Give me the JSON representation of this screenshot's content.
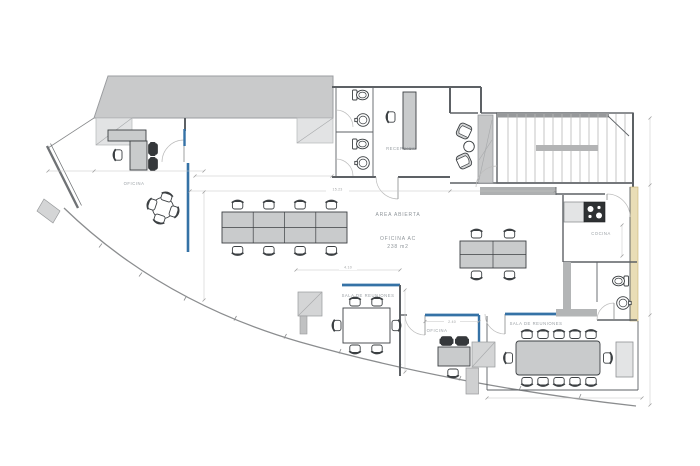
{
  "meta": {
    "title": "Office floor plan"
  },
  "colors": {
    "background": "#ffffff",
    "wall_band": "#c9cacb",
    "wall_gray": "#b3b5b6",
    "column_gray": "#d4d5d6",
    "line_dark": "#5d6165",
    "glass_blue": "#3572a6",
    "accent_tan": "#e9ddb6",
    "furniture_gray": "#c9cbcc",
    "furniture_dark": "#35383b",
    "label_gray": "#8f959a",
    "dim_gray": "#a3a5a7"
  },
  "labels": {
    "oficina_left": "OFICINA",
    "area_abierta": "AREA ABIERTA",
    "oficina_ac": "OFICINA AC",
    "oficina_ac_area": "238 m2",
    "recepcion": "RECEPCION",
    "cocina": "COCINA",
    "sala_reuniones_center": "SALA DE REUNIONES",
    "oficina_bottom": "OFICINA",
    "sala_reuniones_right": "SALA DE REUNIONES"
  },
  "dimensions": {
    "open_area_width": "15.23",
    "meeting_room_width": "4.10",
    "office_width": "2.40"
  }
}
